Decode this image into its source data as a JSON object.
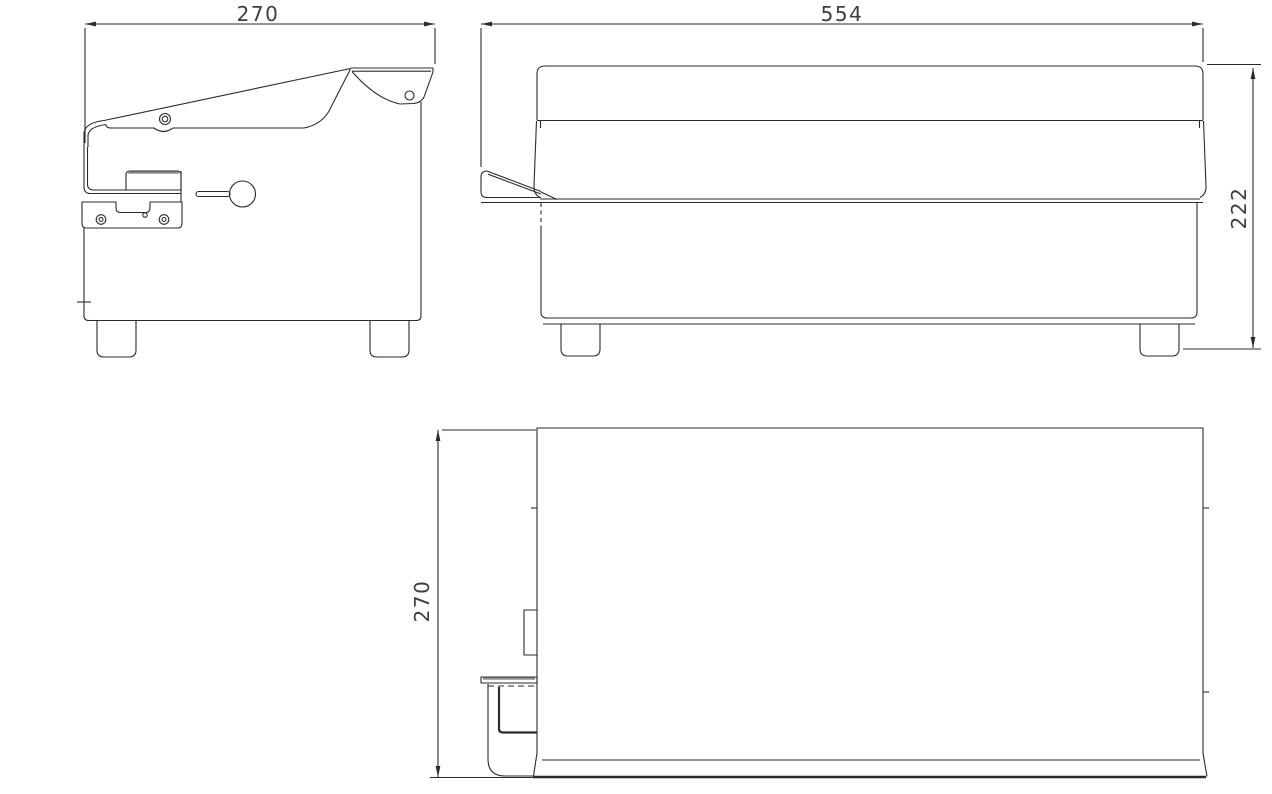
{
  "drawing": {
    "background": "#ffffff",
    "line_color": "#2b2b2b",
    "dim_text_color": "#3d3d3d",
    "dimensions": {
      "side_view_width": "270",
      "front_view_width": "554",
      "front_view_height": "222",
      "top_view_depth": "270"
    }
  }
}
